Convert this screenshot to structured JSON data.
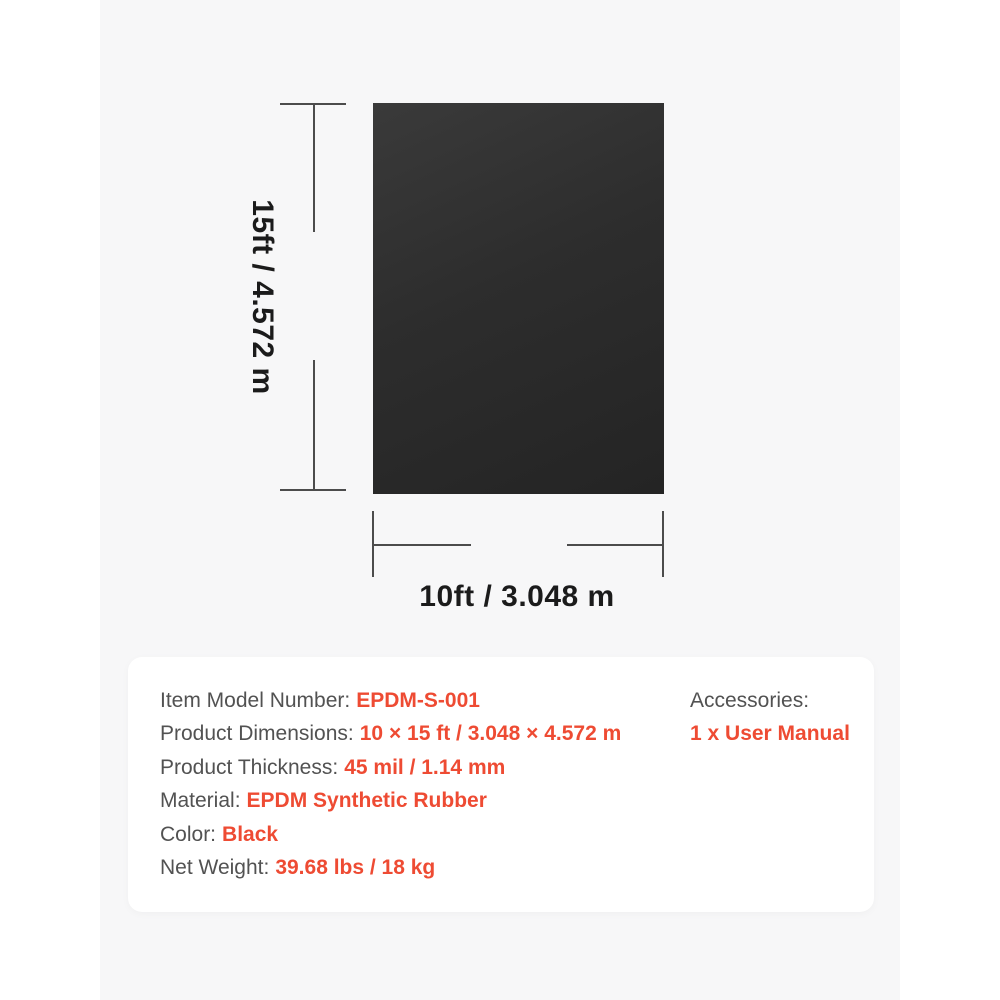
{
  "colors": {
    "canvas_bg": "#ffffff",
    "stage_bg": "#f7f7f8",
    "panel_bg": "#ffffff",
    "sheet_dark": "#2d2d2d",
    "dimension_line": "#4c4c4c",
    "dimension_text": "#1b1b1b",
    "label_gray": "#525252",
    "value_red": "#ee4b33"
  },
  "diagram": {
    "height_label": "15ft / 4.572 m",
    "width_label": "10ft / 3.048 m"
  },
  "specs": {
    "rows": [
      {
        "label": "Item Model Number:",
        "value": "EPDM-S-001"
      },
      {
        "label": "Product Dimensions:",
        "value": "10 × 15 ft / 3.048 × 4.572 m"
      },
      {
        "label": "Product Thickness:",
        "value": "45 mil / 1.14 mm"
      },
      {
        "label": "Material:",
        "value": "EPDM Synthetic Rubber"
      },
      {
        "label": "Color:",
        "value": "Black"
      },
      {
        "label": "Net Weight:",
        "value": "39.68 lbs / 18 kg"
      }
    ],
    "accessories": {
      "label": "Accessories:",
      "value": "1 x User Manual"
    }
  }
}
